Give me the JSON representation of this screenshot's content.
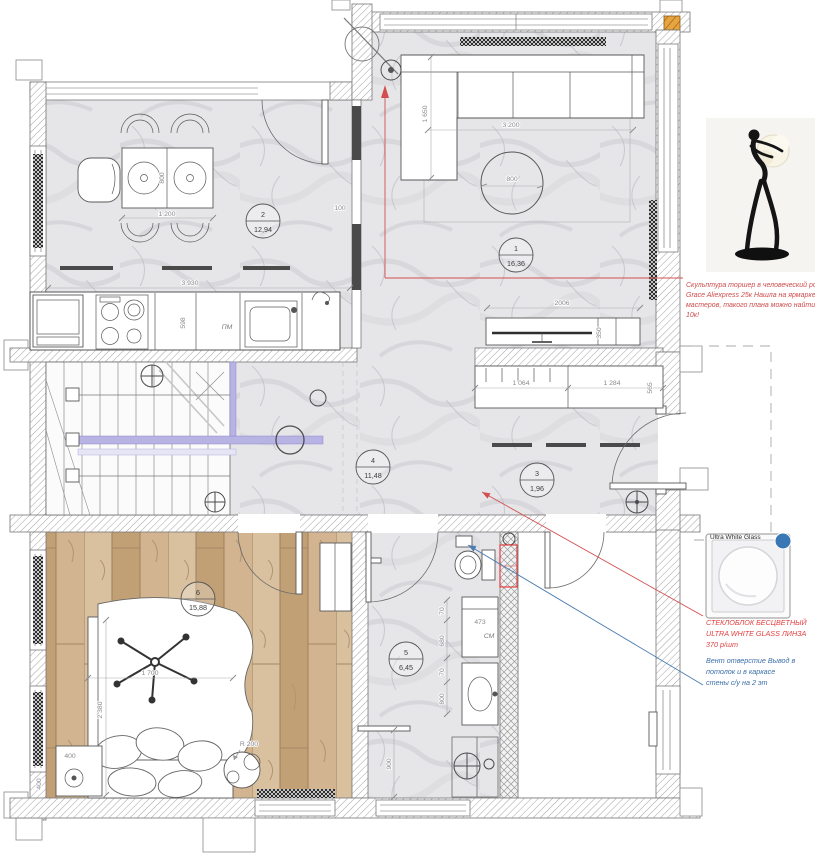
{
  "rooms": [
    {
      "num": "1",
      "area": "16,36"
    },
    {
      "num": "2",
      "area": "12,94"
    },
    {
      "num": "3",
      "area": "1,96"
    },
    {
      "num": "4",
      "area": "11,48"
    },
    {
      "num": "5",
      "area": "6,45"
    },
    {
      "num": "6",
      "area": "15,88"
    }
  ],
  "dims": {
    "d3930": "3 930",
    "d1200": "1 200",
    "d800t": "800",
    "d100": "100",
    "d598": "598",
    "dPM": "ПМ",
    "d3200": "3 200",
    "d1650": "1 650",
    "d800c": "800",
    "d2006": "2006",
    "d350": "350",
    "d1064": "1 064",
    "d1284": "1 284",
    "d565": "565",
    "d1700": "1 700",
    "d2380": "2 380",
    "d400a": "400",
    "d400b": "400",
    "dR200": "R 200",
    "d473": "473",
    "dCM": "СМ",
    "d70a": "70",
    "d680": "680",
    "d70b": "70",
    "d800b": "800",
    "d900": "900"
  },
  "annotations": {
    "sculpture": {
      "color": "#cf4b4b",
      "lines": [
        "Скульптура торшер в человеческий рост",
        "Grace  Aliexpress 25к Нашла на ярмарке",
        "мастеров, такого плана можно найти до",
        "10к!"
      ]
    },
    "glass": {
      "swatch_label": "Ultra White Glass",
      "color": "#e33f3f",
      "lines": [
        "СТЕКЛОБЛОК БЕСЦВЕТНЫЙ",
        "ULTRA WHITE GLASS ЛИНЗА",
        "370 р/шт"
      ]
    },
    "vent": {
      "color": "#3c6fa8",
      "lines": [
        "Вент отверстие Вывод в",
        "потолок и в каркасе",
        "стены с/у на 2 эт"
      ]
    }
  }
}
